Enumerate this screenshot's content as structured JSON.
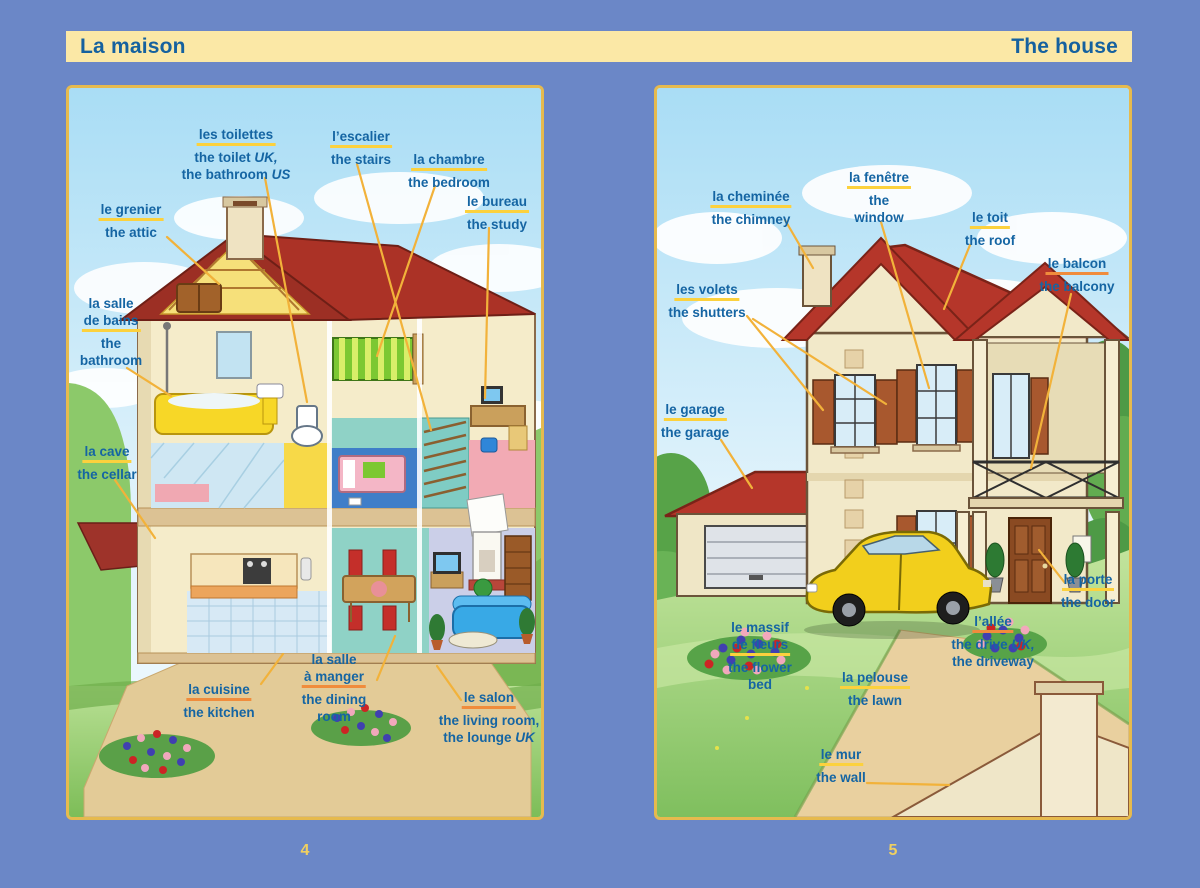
{
  "colors": {
    "background": "#6b87c7",
    "header_band": "#fbe8a6",
    "title_text": "#15619f",
    "label_text": "#1565a3",
    "underline_yellow": "#fcd13d",
    "underline_orange": "#f08c3c",
    "leader_line": "#f2b23a",
    "page_number": "#f0d060",
    "panel_border": "#e6ba4e"
  },
  "header": {
    "left_title": "La maison",
    "right_title": "The house"
  },
  "left_page": {
    "page_number": "4",
    "scene": "cutaway house interior",
    "labels": [
      {
        "id": "grenier",
        "fr": [
          "le grenier"
        ],
        "en": [
          {
            "t": "the attic"
          }
        ]
      },
      {
        "id": "toilettes",
        "fr": [
          "les toilettes"
        ],
        "en": [
          {
            "t": "the toilet ",
            "i": "UK,"
          },
          {
            "t": "the bathroom ",
            "i": "US"
          }
        ]
      },
      {
        "id": "escalier",
        "fr": [
          "l’escalier"
        ],
        "en": [
          {
            "t": "the stairs"
          }
        ]
      },
      {
        "id": "chambre",
        "fr": [
          "la chambre"
        ],
        "en": [
          {
            "t": "the bedroom"
          }
        ]
      },
      {
        "id": "bureau",
        "fr": [
          "le bureau"
        ],
        "en": [
          {
            "t": "the study"
          }
        ]
      },
      {
        "id": "salle-de-bains",
        "fr": [
          "la salle",
          "de bains"
        ],
        "en": [
          {
            "t": "the"
          },
          {
            "t": "bathroom"
          }
        ]
      },
      {
        "id": "cave",
        "fr": [
          "la cave"
        ],
        "en": [
          {
            "t": "the cellar"
          }
        ]
      },
      {
        "id": "cuisine",
        "fr": [
          "la cuisine"
        ],
        "en": [
          {
            "t": "the kitchen"
          }
        ]
      },
      {
        "id": "salle-a-manger",
        "fr": [
          "la salle",
          "à manger"
        ],
        "en": [
          {
            "t": "the dining"
          },
          {
            "t": "room"
          }
        ]
      },
      {
        "id": "salon",
        "fr": [
          "le salon"
        ],
        "en": [
          {
            "t": "the living room,"
          },
          {
            "t": "the lounge ",
            "i": "UK"
          }
        ]
      }
    ]
  },
  "right_page": {
    "page_number": "5",
    "scene": "house exterior with garden",
    "labels": [
      {
        "id": "cheminee",
        "fr": [
          "la cheminée"
        ],
        "en": [
          {
            "t": "the chimney"
          }
        ]
      },
      {
        "id": "fenetre",
        "fr": [
          "la fenêtre"
        ],
        "en": [
          {
            "t": "the"
          },
          {
            "t": "window"
          }
        ]
      },
      {
        "id": "toit",
        "fr": [
          "le toit"
        ],
        "en": [
          {
            "t": "the roof"
          }
        ]
      },
      {
        "id": "balcon",
        "fr": [
          "le balcon"
        ],
        "en": [
          {
            "t": "the balcony"
          }
        ]
      },
      {
        "id": "volets",
        "fr": [
          "les volets"
        ],
        "en": [
          {
            "t": "the shutters"
          }
        ]
      },
      {
        "id": "garage",
        "fr": [
          "le garage"
        ],
        "en": [
          {
            "t": "the garage"
          }
        ]
      },
      {
        "id": "porte",
        "fr": [
          "la porte"
        ],
        "en": [
          {
            "t": "the door"
          }
        ]
      },
      {
        "id": "allee",
        "fr": [
          "l’allée"
        ],
        "en": [
          {
            "t": "the drive ",
            "i": "UK,"
          },
          {
            "t": "the driveway"
          }
        ]
      },
      {
        "id": "massif",
        "fr": [
          "le massif",
          "de fleurs"
        ],
        "en": [
          {
            "t": "the flower"
          },
          {
            "t": "bed"
          }
        ]
      },
      {
        "id": "pelouse",
        "fr": [
          "la pelouse"
        ],
        "en": [
          {
            "t": "the lawn"
          }
        ]
      },
      {
        "id": "mur",
        "fr": [
          "le mur"
        ],
        "en": [
          {
            "t": "the wall"
          }
        ]
      }
    ]
  }
}
